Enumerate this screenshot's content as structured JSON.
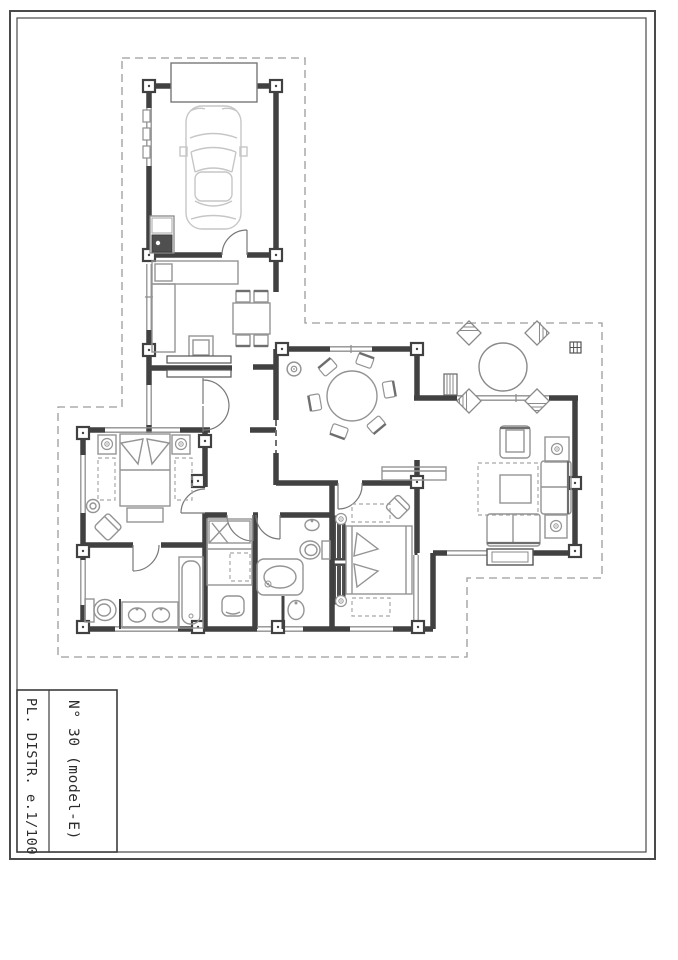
{
  "title_block": {
    "project": "N° 30 (model-E)",
    "sheet": "PL. DISTR. e.1/100"
  },
  "colors": {
    "paper": "#ffffff",
    "frame": "#4a4a4a",
    "wall": "#414141",
    "window": "#8f8f8f",
    "furniture": "#949494",
    "furniture_light": "#c6c6c6",
    "door_swing": "#787878",
    "property_line": "#9c9c9c"
  },
  "plan": {
    "type": "architectural-floor-plan",
    "rooms": [
      "garage",
      "kitchen",
      "entry-hall",
      "dining-nook",
      "dining-area",
      "living-room",
      "corridor",
      "master-bedroom",
      "ensuite-bathroom",
      "bedroom-2",
      "bathroom-2",
      "bedroom-3",
      "terrace"
    ],
    "symbols": [
      "car-icon",
      "garage-door-icon",
      "water-heater-icon",
      "kitchen-counter-icon",
      "dining-table-icon",
      "round-table-icon",
      "patio-table-icon",
      "ceiling-light-icon",
      "sideboard-icon",
      "chimney-icon",
      "drain-icon",
      "armchair-icon",
      "sofa-icon",
      "coffee-table-icon",
      "side-table-lamp-icon",
      "rug-icon",
      "fireplace-icon",
      "double-bed-icon",
      "single-bed-icon",
      "nightstand-lamp-icon",
      "bench-icon",
      "corner-chair-icon",
      "toilet-icon",
      "double-sink-vanity-icon",
      "bathtub-icon",
      "shower-icon",
      "sink-icon",
      "wardrobe-icon",
      "door-swing-icon",
      "window-icon",
      "pillar-icon",
      "property-line-icon"
    ]
  }
}
